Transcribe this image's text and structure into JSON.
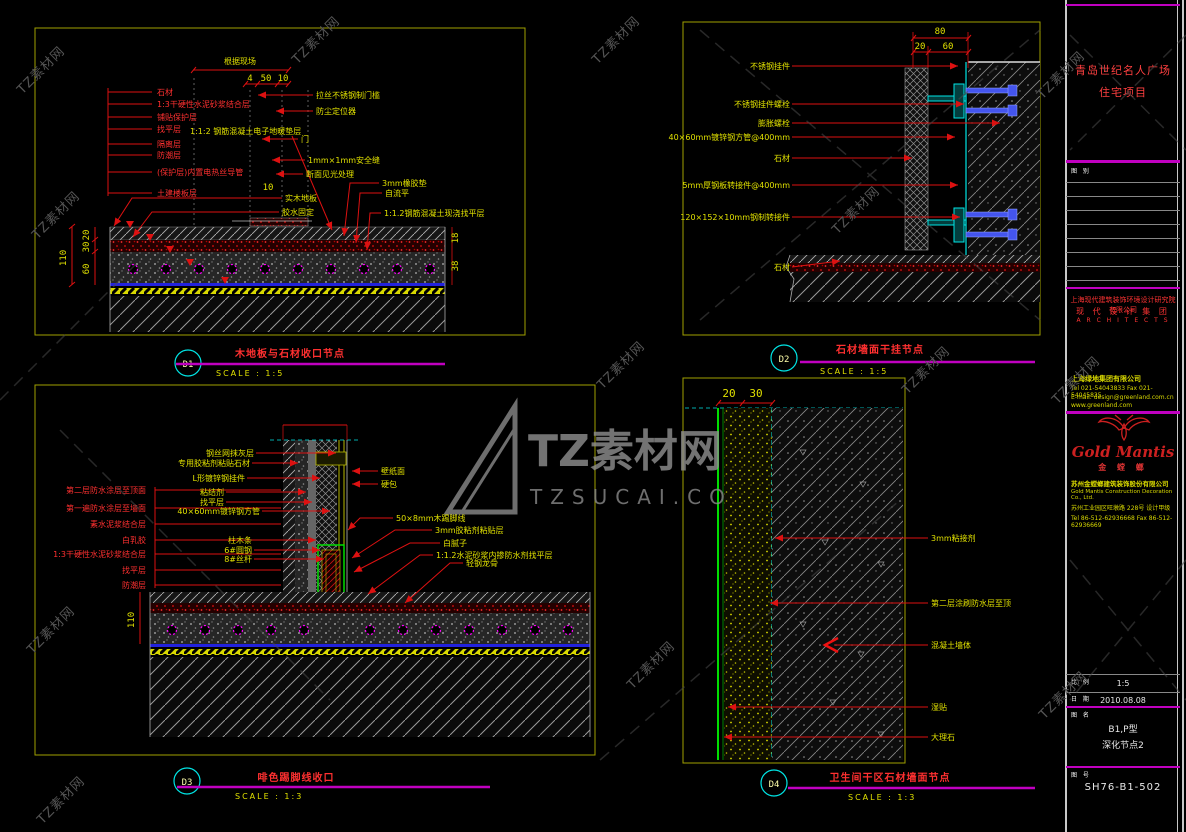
{
  "watermark": {
    "brand": "TZ素材网",
    "domain": "TZSUCAI.CO"
  },
  "captions": {
    "d1": {
      "bubble": "D1",
      "title": "木地板与石材收口节点",
      "scale": "SCALE : 1:5"
    },
    "d2": {
      "bubble": "D2",
      "title": "石材墙面干挂节点",
      "scale": "SCALE : 1:5"
    },
    "d3": {
      "bubble": "D3",
      "title": "啡色踢脚线收口",
      "scale": "SCALE : 1:3"
    },
    "d4": {
      "bubble": "D4",
      "title": "卫生间干区石材墙面节点",
      "scale": "SCALE : 1:3"
    }
  },
  "d1": {
    "top_note": "根据现场",
    "dims": {
      "a": "4",
      "b": "50",
      "c": "10",
      "total": "110",
      "s1": "20",
      "s2": "30",
      "s3": "60",
      "mid": "10",
      "r1": "18",
      "r2": "38"
    },
    "labels_left": [
      "石材",
      "1:3干硬性水泥砂浆结合层",
      "铺贴保护层",
      "找平层",
      "隔离层",
      "防潮层",
      "(保护层)内置电热丝导管",
      "土建楼板层"
    ],
    "mid_label": "1:1:2 钢筋混凝土电子地暖垫层",
    "labels_right": [
      "拉丝不锈钢制门槛",
      "防尘定位器",
      "门",
      "1mm×1mm安全缝",
      "断面见光处理",
      "实木地板",
      "胶水固定",
      "3mm橡胶垫",
      "自流平",
      "1:1.2钢筋混凝土现浇找平层"
    ]
  },
  "d2": {
    "dims": {
      "total": "80",
      "a": "20",
      "b": "60"
    },
    "labels_left": [
      "不锈钢挂件",
      "不锈钢挂件螺栓",
      "膨胀螺栓",
      "40×60mm镀锌钢方管@400mm",
      "石材",
      "5mm厚钢板转接件@400mm",
      "120×152×10mm钢制转接件",
      "石材"
    ]
  },
  "d3": {
    "dim_total": "110",
    "labels_red": [
      "第二层防水涂层至顶面",
      "第一遍防水涂层至墙面",
      "素水泥浆结合层",
      "白乳胶",
      "1:3干硬性水泥砂浆结合层",
      "找平层",
      "防潮层"
    ],
    "labels_top": [
      "钢丝网抹灰层",
      "专用胶粘剂粘贴石材",
      "L形镀锌钢挂件",
      "粘结剂",
      "找平层",
      "40×60mm镀锌钢方管"
    ],
    "labels_mid": [
      "柱木条",
      "6#圆钢",
      "8#丝杆"
    ],
    "labels_right": [
      "壁纸面",
      "硬包",
      "50×8mm木踢脚线",
      "3mm胶粘剂粘贴层",
      "白腻子",
      "1:1.2水泥砂浆内掺防水剂找平层",
      "轻钢龙骨"
    ]
  },
  "d4": {
    "dims": {
      "a": "20",
      "b": "30"
    },
    "labels_right": [
      "3mm粘接剂",
      "第二层涂刷防水层至顶",
      "混凝土墙体",
      "湿贴",
      "大理石"
    ]
  },
  "titleblock": {
    "project_line1": "青岛世纪名人广场",
    "project_line2": "住宅项目",
    "rev_label": "图 别",
    "firm_cn": "上海现代建筑装饰环境设计研究院有限公司",
    "firm_cn2": "现 代 设 计 集 团",
    "firm_en": "A R C H I T E C T S",
    "client": [
      "上海绿地集团有限公司",
      "Tel 021-54043833  Fax 021-54045835",
      "E-mail: design@greenland.com.cn",
      "www.greenland.com"
    ],
    "logo_script": "Gold Mantis",
    "logo_cn": "金 螳 螂",
    "contractor": [
      "苏州金螳螂建筑装饰股份有限公司",
      "Gold Mantis Construction Decoration Co., Ltd.",
      "苏州工业园区旺墩路 228号  设计甲级",
      "Tel 86-512-62936668  Fax 86-512-62936669"
    ],
    "scale_label": "比 例",
    "scale_value": "1:5",
    "date_label": "日 期",
    "date_value": "2010.08.08",
    "name_label": "图 名",
    "name_line1": "B1,P型",
    "name_line2": "深化节点2",
    "no_label": "图 号",
    "no_value": "SH76-B1-502"
  }
}
